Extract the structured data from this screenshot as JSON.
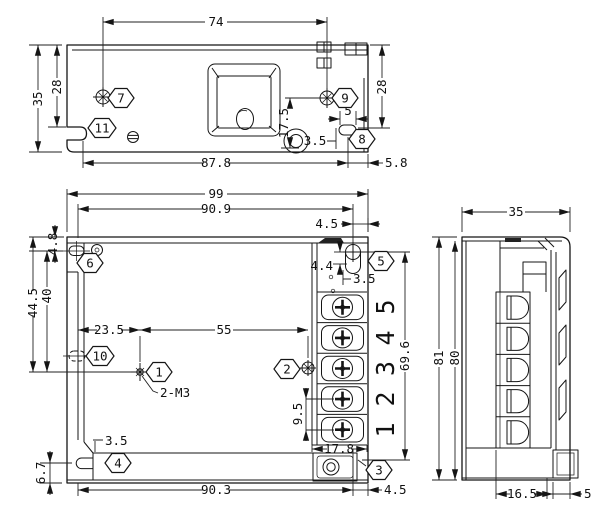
{
  "drawing": {
    "title": "Enclosed power supply mechanical drawing, three views",
    "colors": {
      "line": "#151515",
      "background": "#ffffff"
    },
    "top_view": {
      "dims": {
        "hole_span": "74",
        "height_overall": "35",
        "height_to_notch": "28",
        "height_right": "28",
        "pot_offset": "17.5",
        "slot_length": "5",
        "slot_inset": "3.5",
        "body_length": "87.8",
        "end_offset": "5.8"
      },
      "balloons": {
        "b7": "7",
        "b9": "9",
        "b11": "11",
        "b8": "8"
      }
    },
    "front_view": {
      "dims": {
        "width_overall": "99",
        "width_mount": "90.9",
        "edge_offset_top": "4.5",
        "flange_offset": "4.8",
        "hole_height_outer": "44.5",
        "hole_height": "40",
        "hole_inset": "23.5",
        "hole_span": "55",
        "screw_offset_v": "4.4",
        "screw_offset_h": "3.5",
        "terminal_span": "69.6",
        "terminal_pitch": "9.5",
        "block_width": "17.8",
        "foot_step": "3.5",
        "foot_height": "6.7",
        "base_length": "90.3",
        "edge_offset_bottom": "4.5"
      },
      "thread_label": "2-M3",
      "terminals": [
        "1",
        "2",
        "3",
        "4",
        "5"
      ],
      "balloons": {
        "b1": "1",
        "b2": "2",
        "b3": "3",
        "b4": "4",
        "b5": "5",
        "b6": "6",
        "b10": "10"
      }
    },
    "side_view": {
      "dims": {
        "depth_overall": "35",
        "height_overall": "81",
        "height_body": "80",
        "base_depth": "16.5",
        "cover_depth": "5"
      }
    }
  }
}
